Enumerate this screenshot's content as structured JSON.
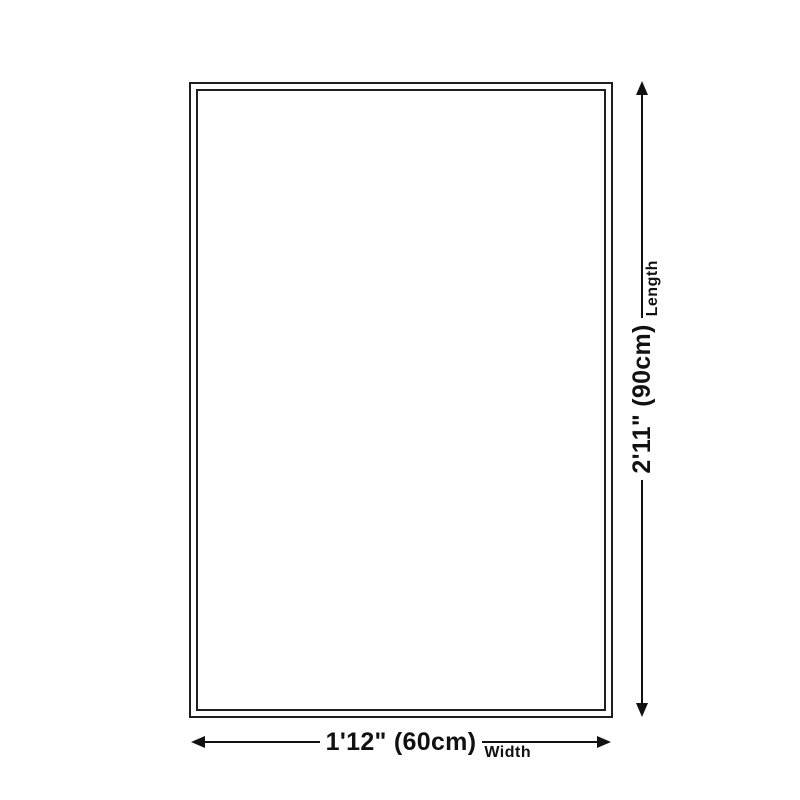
{
  "page": {
    "background": "#ffffff"
  },
  "diagram": {
    "vertical_dimension": {
      "value": "2'11\" (90cm)",
      "axis_label": "Length"
    },
    "horizontal_dimension": {
      "value": "1'12\" (60cm)",
      "axis_label": "Width"
    },
    "colors": {
      "line": "#111111",
      "text": "#111111",
      "rug_border": "#1f1f1f",
      "background": "#ffffff"
    }
  }
}
